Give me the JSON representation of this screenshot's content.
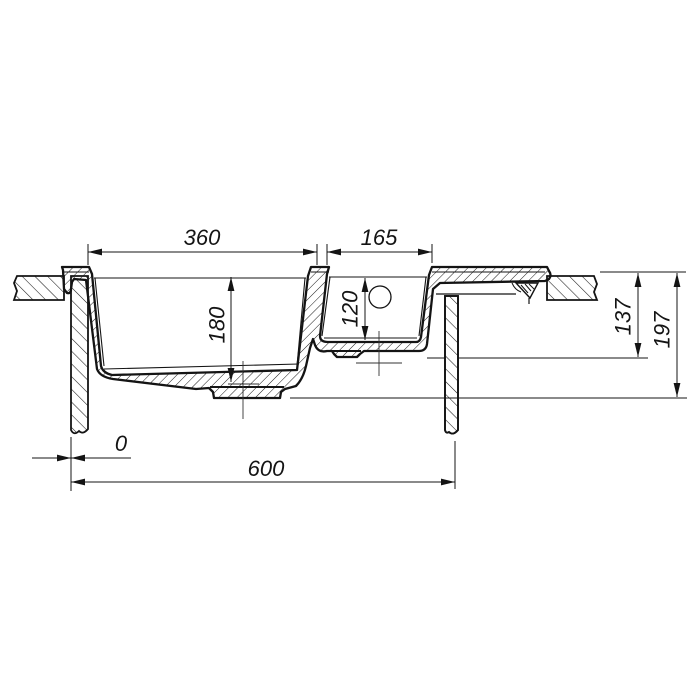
{
  "drawing": {
    "background": "#ffffff",
    "line_color": "#141414",
    "dimensions": {
      "main_bowl_width": "360",
      "small_bowl_width": "165",
      "main_bowl_depth": "180",
      "small_bowl_depth": "120",
      "small_bowl_height": "137",
      "overall_height": "197",
      "zero_offset": "0",
      "overall_width": "600"
    }
  }
}
